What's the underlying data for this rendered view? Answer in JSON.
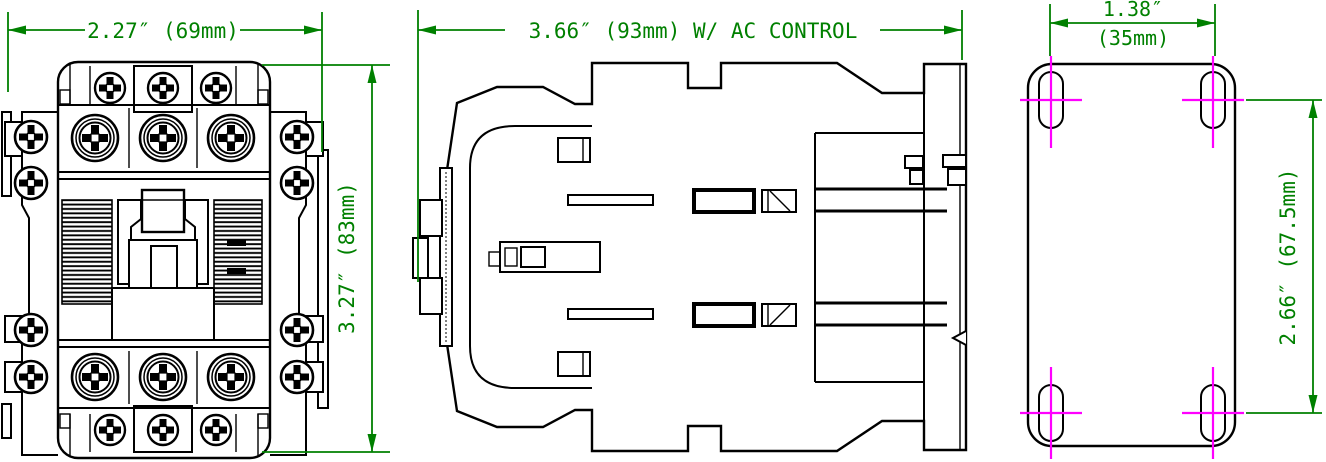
{
  "drawing": {
    "type": "engineering-dimension-drawing",
    "subject": "contactor",
    "background": "#ffffff",
    "line_color": "#000000",
    "dimension_color": "#008000",
    "centerline_color": "#ff00ff",
    "views": [
      {
        "id": "front",
        "name": "front-view"
      },
      {
        "id": "side",
        "name": "side-view"
      },
      {
        "id": "mounting",
        "name": "mounting-hole-view"
      }
    ],
    "dimensions": {
      "front_width": "2.27″ (69mm)",
      "front_height": "3.27″ (83mm)",
      "side_width": "3.66″ (93mm) W/ AC CONTROL",
      "mount_width_line1": "1.38″",
      "mount_width_line2": "(35mm)",
      "mount_height": "2.66″ (67.5mm)"
    }
  }
}
